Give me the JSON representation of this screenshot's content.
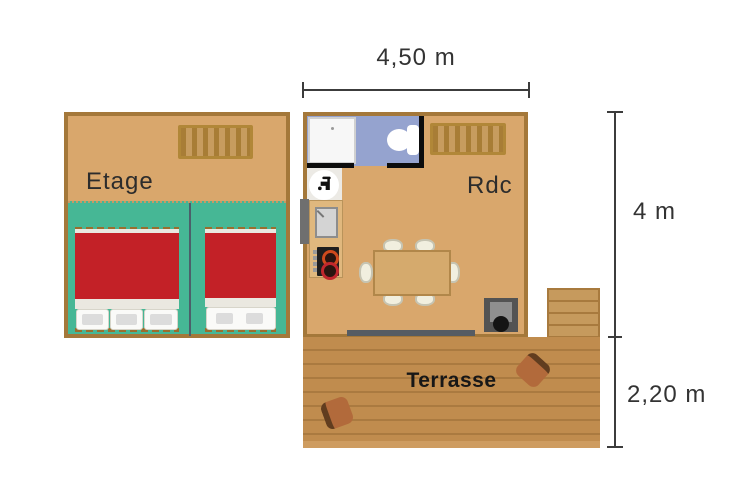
{
  "title": "Cabin floor plan",
  "dimensions": {
    "top": {
      "label": "4,50 m"
    },
    "right_upper": {
      "label": "4 m"
    },
    "right_lower": {
      "label": "2,20 m"
    }
  },
  "floors": {
    "etage": {
      "label": "Etage"
    },
    "rdc": {
      "label": "Rdc"
    },
    "terrasse": {
      "label": "Terrasse"
    }
  },
  "furniture": {
    "etage": [
      "staircase-icon",
      "triple-single-beds",
      "double-bed"
    ],
    "rdc": [
      "shower-icon",
      "toilet-icon",
      "water-tap-icon",
      "staircase-icon",
      "kitchen-sink-icon",
      "cooktop-icon",
      "dining-table",
      "six-chairs",
      "wood-stove-icon",
      "sliding-door",
      "side-door"
    ],
    "terrasse": [
      "deck-chair",
      "deck-chair",
      "outdoor-steps"
    ]
  },
  "counts": {
    "etage_left_pillows": 3,
    "etage_right_pillows": 2,
    "dining_chairs": 6
  },
  "colors": {
    "wall": "#a4783a",
    "floor": "#d9a76c",
    "bedroom_green": "#46b795",
    "bed_red": "#c32127",
    "bathroom_blue": "#95a3cf",
    "terrace": "#c08c4e",
    "dimension_line": "#3c3c3c",
    "text": "#2c2c2c",
    "black_wall": "#0d0d0d"
  }
}
